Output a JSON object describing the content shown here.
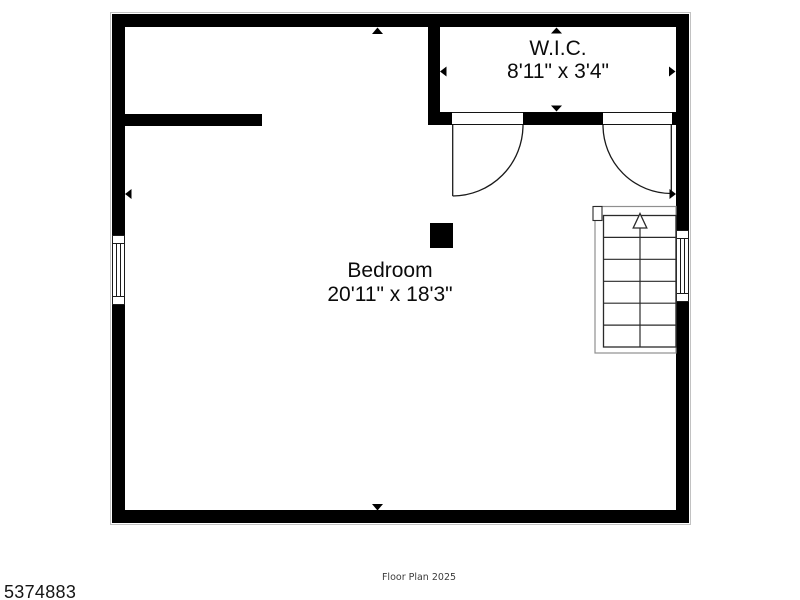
{
  "rooms": {
    "wic": {
      "name": "W.I.C.",
      "dims": "8'11\" x 3'4\""
    },
    "bedroom": {
      "name": "Bedroom",
      "dims": "20'11\" x 18'3\""
    }
  },
  "footer": {
    "listing_id": "5374883",
    "caption": "Floor Plan 2025"
  },
  "symbols": {
    "stairs_direction_icon": "open-triangle-up-arrow",
    "measurement_arrow_icon": "solid-triangle",
    "window_icon": "double-pane-window",
    "door_icon": "quarter-circle-swing"
  },
  "colors": {
    "wall": "#000000",
    "line": "#1a1a1a",
    "stair_enclosure": "#8f8f8f",
    "background": "#ffffff",
    "caption_text": "#3c3c3c"
  }
}
